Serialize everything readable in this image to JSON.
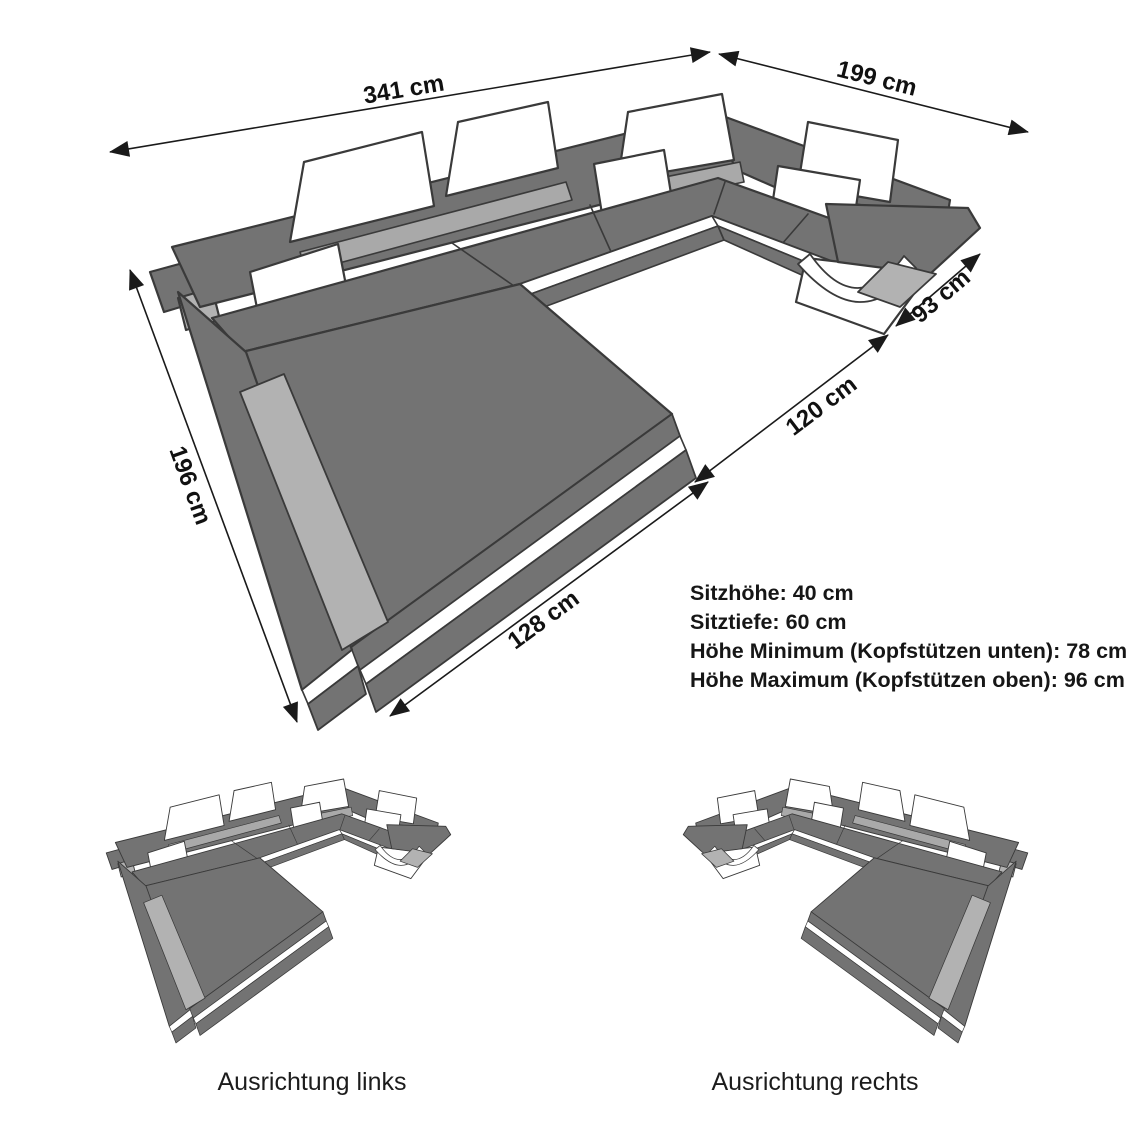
{
  "diagram": {
    "dimensions": {
      "top": "341 cm",
      "right": "199 cm",
      "arm": "93 cm",
      "inner": "120 cm",
      "left": "196 cm",
      "front": "128 cm"
    },
    "specs": {
      "seat_height": "Sitzhöhe: 40 cm",
      "seat_depth": "Sitztiefe: 60 cm",
      "height_min": "Höhe Minimum (Kopfstützen unten): 78 cm",
      "height_max": "Höhe Maximum (Kopfstützen oben): 96 cm"
    },
    "variants": {
      "left": "Ausrichtung links",
      "right": "Ausrichtung rechts"
    },
    "colors": {
      "sofa_gray": "#737373",
      "panel_light_gray": "#b2b2b2",
      "rail_gray": "#a9a9a9",
      "outline": "#3a3a3a",
      "white": "#ffffff",
      "dimension_line": "#1a1a1a"
    }
  }
}
